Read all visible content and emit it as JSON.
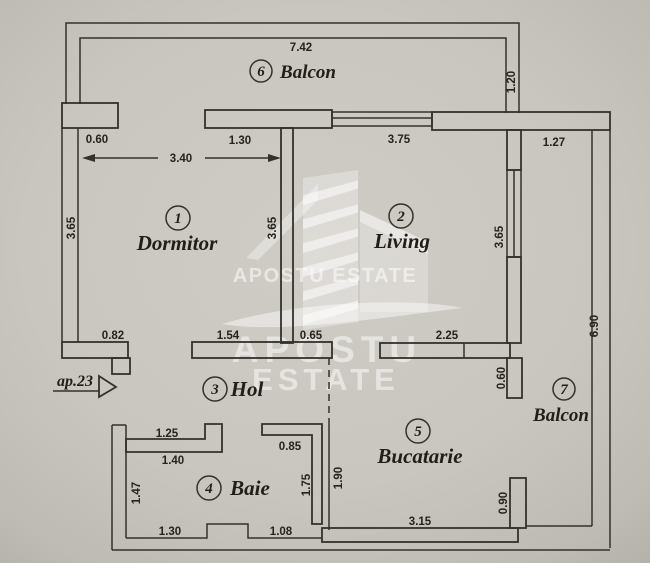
{
  "plan": {
    "entrance_label": "ap.23",
    "watermark": {
      "small_line": "APOSTU ESTATE",
      "big_word1": "APOSTU",
      "big_word2": "ESTATE"
    },
    "rooms": {
      "dormitor": {
        "num": "1",
        "name": "Dormitor"
      },
      "living": {
        "num": "2",
        "name": "Living"
      },
      "hol": {
        "num": "3",
        "name": "Hol"
      },
      "baie": {
        "num": "4",
        "name": "Baie"
      },
      "bucatarie": {
        "num": "5",
        "name": "Bucatarie"
      },
      "balcon6": {
        "num": "6",
        "name": "Balcon"
      },
      "balcon7": {
        "num": "7",
        "name": "Balcon"
      }
    },
    "dims": {
      "balcon6_len": "7.42",
      "balcon6_depth": "1.20",
      "dorm_top_left": "0.60",
      "dorm_top_right": "1.30",
      "dorm_width": "3.40",
      "dorm_left_h": "3.65",
      "dorm_right_h": "3.65",
      "living_top_window": "3.75",
      "living_right_window_h": "3.65",
      "balcon7_top": "1.27",
      "balcon7_len": "6.90",
      "dorm_bottom_step": "0.82",
      "hol_top_left": "1.54",
      "hol_top_right": "0.65",
      "living_bottom": "2.25",
      "buc_balcony_wall_top": "0.60",
      "buc_balcony_wall_bottom": "0.90",
      "buc_left_h": "1.90",
      "buc_bottom": "3.15",
      "baie_top_outer": "1.25",
      "baie_top_inner": "1.40",
      "baie_left_h": "1.47",
      "baie_right_top": "0.85",
      "baie_right_h": "1.75",
      "baie_bottom_left": "1.30",
      "baie_bottom_right": "1.08"
    },
    "colors": {
      "paper": "#c9c6bf",
      "line": "#34312b",
      "watermark": "#ffffff"
    }
  }
}
